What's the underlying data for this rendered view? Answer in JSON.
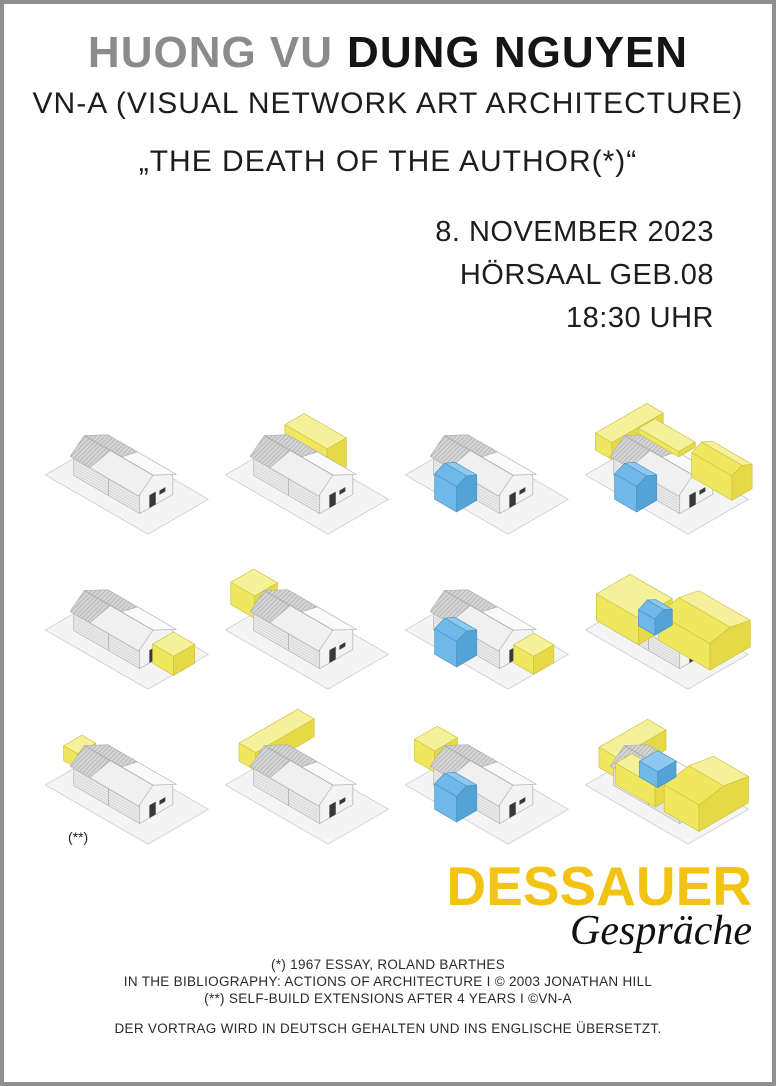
{
  "poster": {
    "title": {
      "speaker1": "HUONG VU",
      "speaker2": "DUNG NGUYEN"
    },
    "subtitle": "VN-A (VISUAL NETWORK ART ARCHITECTURE)",
    "quote": "„THE DEATH OF THE AUTHOR(*)“",
    "event": {
      "date": "8. NOVEMBER 2023",
      "location": "HÖRSAAL GEB.08",
      "time": "18:30 UHR"
    },
    "footnote_marker": "(**)",
    "logo": {
      "name": "DESSAUER",
      "sub": "Gespräche"
    },
    "credits": [
      "(*) 1967 ESSAY, ROLAND BARTHES",
      "IN THE BIBLIOGRAPHY: ACTIONS OF ARCHITECTURE I © 2003 JONATHAN HILL",
      "(**) SELF-BUILD EXTENSIONS AFTER 4 YEARS I ©VN-A"
    ],
    "language_note": "DER VORTRAG WIRD IN DEUTSCH GEHALTEN UND INS ENGLISCHE ÜBERSETZT."
  },
  "colors": {
    "frame": "#8f8f8f",
    "title_gray": "#8b8b8b",
    "title_black": "#151515",
    "logo_yellow": "#f3c313",
    "plot_fill": "#f4f4f4",
    "plot_edge": "#c9c9c9",
    "house_edge": "#b0b0b0",
    "yellow": {
      "top": "#f5f09a",
      "left": "#efe85f",
      "right": "#e5da45",
      "edge": "#cdbf3e"
    },
    "blue": {
      "top": "#8dc9ee",
      "left": "#6fb9e8",
      "right": "#54a3d6",
      "edge": "#4a90c0"
    }
  },
  "diagram": {
    "description": "12 axonometric drawings of the same gabled house with self-build extensions (yellow) and additions (blue), 3 rows x 4 columns",
    "rows": 3,
    "cols": 4,
    "cells": [
      {
        "id": "r1c1",
        "extensions": []
      },
      {
        "id": "r1c2",
        "extensions": [
          {
            "color": "yellow",
            "layer": "back",
            "box": [
              -0.2,
              4.4,
              -2.1,
              0.0,
              0.0,
              2.9
            ]
          }
        ]
      },
      {
        "id": "r1c3",
        "extensions": [
          {
            "color": "blue",
            "layer": "front",
            "ridge": true,
            "box": [
              2.3,
              4.7,
              3.6,
              5.8,
              0.0,
              2.4
            ]
          }
        ]
      },
      {
        "id": "r1c4",
        "extensions": [
          {
            "color": "yellow",
            "layer": "back",
            "box": [
              -1.6,
              0.2,
              -1.6,
              4.0,
              1.8,
              3.4
            ]
          },
          {
            "color": "blue",
            "layer": "front",
            "ridge": true,
            "box": [
              2.3,
              4.7,
              3.6,
              5.8,
              0.0,
              2.4
            ]
          },
          {
            "color": "yellow",
            "layer": "front",
            "box": [
              0.2,
              4.6,
              -0.7,
              1.1,
              2.8,
              3.3
            ]
          },
          {
            "color": "yellow",
            "layer": "front",
            "ridge": true,
            "box": [
              4.4,
              8.8,
              -2.7,
              -0.5,
              0.0,
              2.3
            ]
          }
        ]
      },
      {
        "id": "r2c1",
        "extensions": [
          {
            "color": "yellow",
            "layer": "front",
            "box": [
              7.4,
              9.7,
              0.1,
              2.4,
              0.0,
              1.8
            ]
          }
        ]
      },
      {
        "id": "r2c2",
        "extensions": [
          {
            "color": "yellow",
            "layer": "back",
            "box": [
              -2.4,
              0.2,
              1.2,
              3.7,
              1.3,
              3.4
            ]
          }
        ]
      },
      {
        "id": "r2c3",
        "extensions": [
          {
            "color": "blue",
            "layer": "front",
            "ridge": true,
            "box": [
              2.3,
              4.7,
              3.6,
              5.8,
              0.0,
              2.4
            ]
          },
          {
            "color": "yellow",
            "layer": "front",
            "box": [
              7.4,
              9.6,
              0.1,
              2.3,
              0.0,
              1.7
            ]
          }
        ]
      },
      {
        "id": "r2c4",
        "extensions": [
          {
            "color": "yellow",
            "layer": "front",
            "box": [
              -1.2,
              3.4,
              0.6,
              4.3,
              0.7,
              3.2
            ]
          },
          {
            "color": "yellow",
            "layer": "front",
            "ridge": true,
            "box": [
              3.4,
              9.0,
              -2.3,
              2.1,
              0.0,
              2.5
            ]
          },
          {
            "color": "blue",
            "layer": "front",
            "ridge": true,
            "box": [
              2.7,
              4.5,
              1.7,
              3.6,
              1.8,
              3.3
            ]
          }
        ]
      },
      {
        "id": "r3c1",
        "extensions": [
          {
            "color": "yellow",
            "layer": "back",
            "box": [
              -1.0,
              0.5,
              1.7,
              3.7,
              1.9,
              3.3
            ]
          }
        ]
      },
      {
        "id": "r3c2",
        "extensions": [
          {
            "color": "yellow",
            "layer": "back",
            "box": [
              -1.4,
              0.4,
              -2.6,
              3.8,
              1.7,
              3.4
            ]
          }
        ]
      },
      {
        "id": "r3c3",
        "extensions": [
          {
            "color": "yellow",
            "layer": "back",
            "box": [
              -1.9,
              0.3,
              1.3,
              3.8,
              1.5,
              3.5
            ]
          },
          {
            "color": "blue",
            "layer": "front",
            "ridge": true,
            "box": [
              2.3,
              4.7,
              3.6,
              5.8,
              0.0,
              2.4
            ]
          }
        ]
      },
      {
        "id": "r3c4",
        "extensions": [
          {
            "color": "yellow",
            "layer": "back",
            "box": [
              -1.1,
              0.9,
              -1.2,
              4.1,
              1.4,
              3.3
            ]
          },
          {
            "color": "yellow",
            "layer": "front",
            "box": [
              0.9,
              5.2,
              2.5,
              4.3,
              0.9,
              2.9
            ]
          },
          {
            "color": "yellow",
            "layer": "front",
            "ridge": true,
            "box": [
              5.2,
              9.0,
              -2.1,
              3.3,
              0.0,
              2.5
            ]
          },
          {
            "color": "blue",
            "layer": "front",
            "box": [
              2.5,
              4.5,
              1.3,
              3.3,
              1.9,
              3.4
            ]
          }
        ]
      }
    ]
  }
}
